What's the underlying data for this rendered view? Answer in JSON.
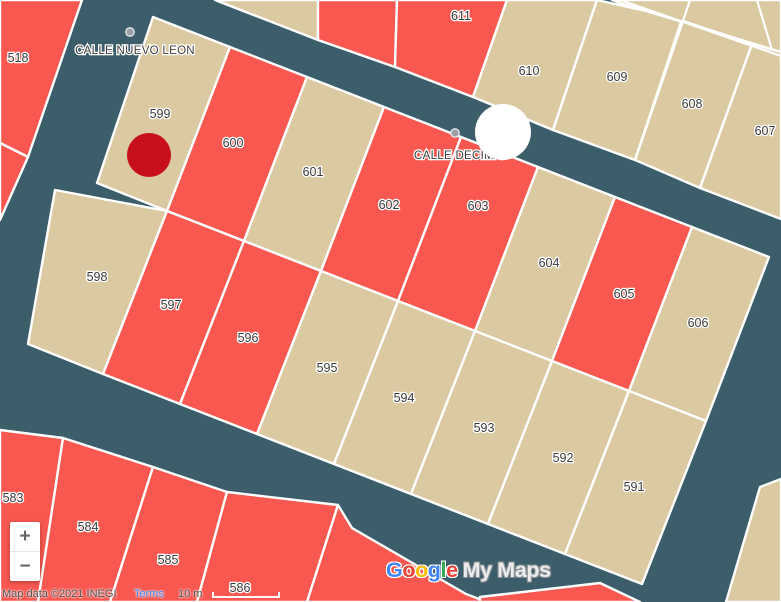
{
  "map": {
    "background_color": "#3B5E6A",
    "parcel_fill_tan": "#DBC9A1",
    "parcel_fill_red": "#F95850",
    "street_labels": [
      {
        "text": "CALLE NUEVO LEON"
      },
      {
        "text": "CALLE DECIMA"
      }
    ],
    "parcels": [
      {
        "label": "518",
        "color": "red"
      },
      {
        "label": "583",
        "color": "red"
      },
      {
        "label": "584",
        "color": "red"
      },
      {
        "label": "585",
        "color": "red"
      },
      {
        "label": "586",
        "color": "red"
      },
      {
        "label": "591",
        "color": "tan"
      },
      {
        "label": "592",
        "color": "tan"
      },
      {
        "label": "593",
        "color": "tan"
      },
      {
        "label": "594",
        "color": "tan"
      },
      {
        "label": "595",
        "color": "tan"
      },
      {
        "label": "596",
        "color": "red"
      },
      {
        "label": "597",
        "color": "red"
      },
      {
        "label": "598",
        "color": "tan"
      },
      {
        "label": "599",
        "color": "tan"
      },
      {
        "label": "600",
        "color": "red"
      },
      {
        "label": "601",
        "color": "tan"
      },
      {
        "label": "602",
        "color": "red"
      },
      {
        "label": "603",
        "color": "red"
      },
      {
        "label": "604",
        "color": "tan"
      },
      {
        "label": "605",
        "color": "red"
      },
      {
        "label": "606",
        "color": "tan"
      },
      {
        "label": "607",
        "color": "tan"
      },
      {
        "label": "608",
        "color": "tan"
      },
      {
        "label": "609",
        "color": "tan"
      },
      {
        "label": "610",
        "color": "tan"
      },
      {
        "label": "611",
        "color": "red"
      }
    ],
    "markers": {
      "red_circle_marker": {
        "color": "#C8101B"
      },
      "white_circle_marker": {
        "color": "#FFFFFF"
      },
      "waypoint_dot": {
        "color": "#9AA0A6"
      }
    }
  },
  "zoom_control": {
    "zoom_in": "+",
    "zoom_out": "−"
  },
  "watermark": {
    "letters": [
      {
        "ch": "G",
        "color": "#4285F4"
      },
      {
        "ch": "o",
        "color": "#EA4335"
      },
      {
        "ch": "o",
        "color": "#FBBC05"
      },
      {
        "ch": "g",
        "color": "#4285F4"
      },
      {
        "ch": "l",
        "color": "#34A853"
      },
      {
        "ch": "e",
        "color": "#EA4335"
      }
    ],
    "suffix": "My Maps"
  },
  "attribution": {
    "map_data": "Map data ©2021 INEGI",
    "terms": "Terms",
    "scale_label": "10 m"
  }
}
